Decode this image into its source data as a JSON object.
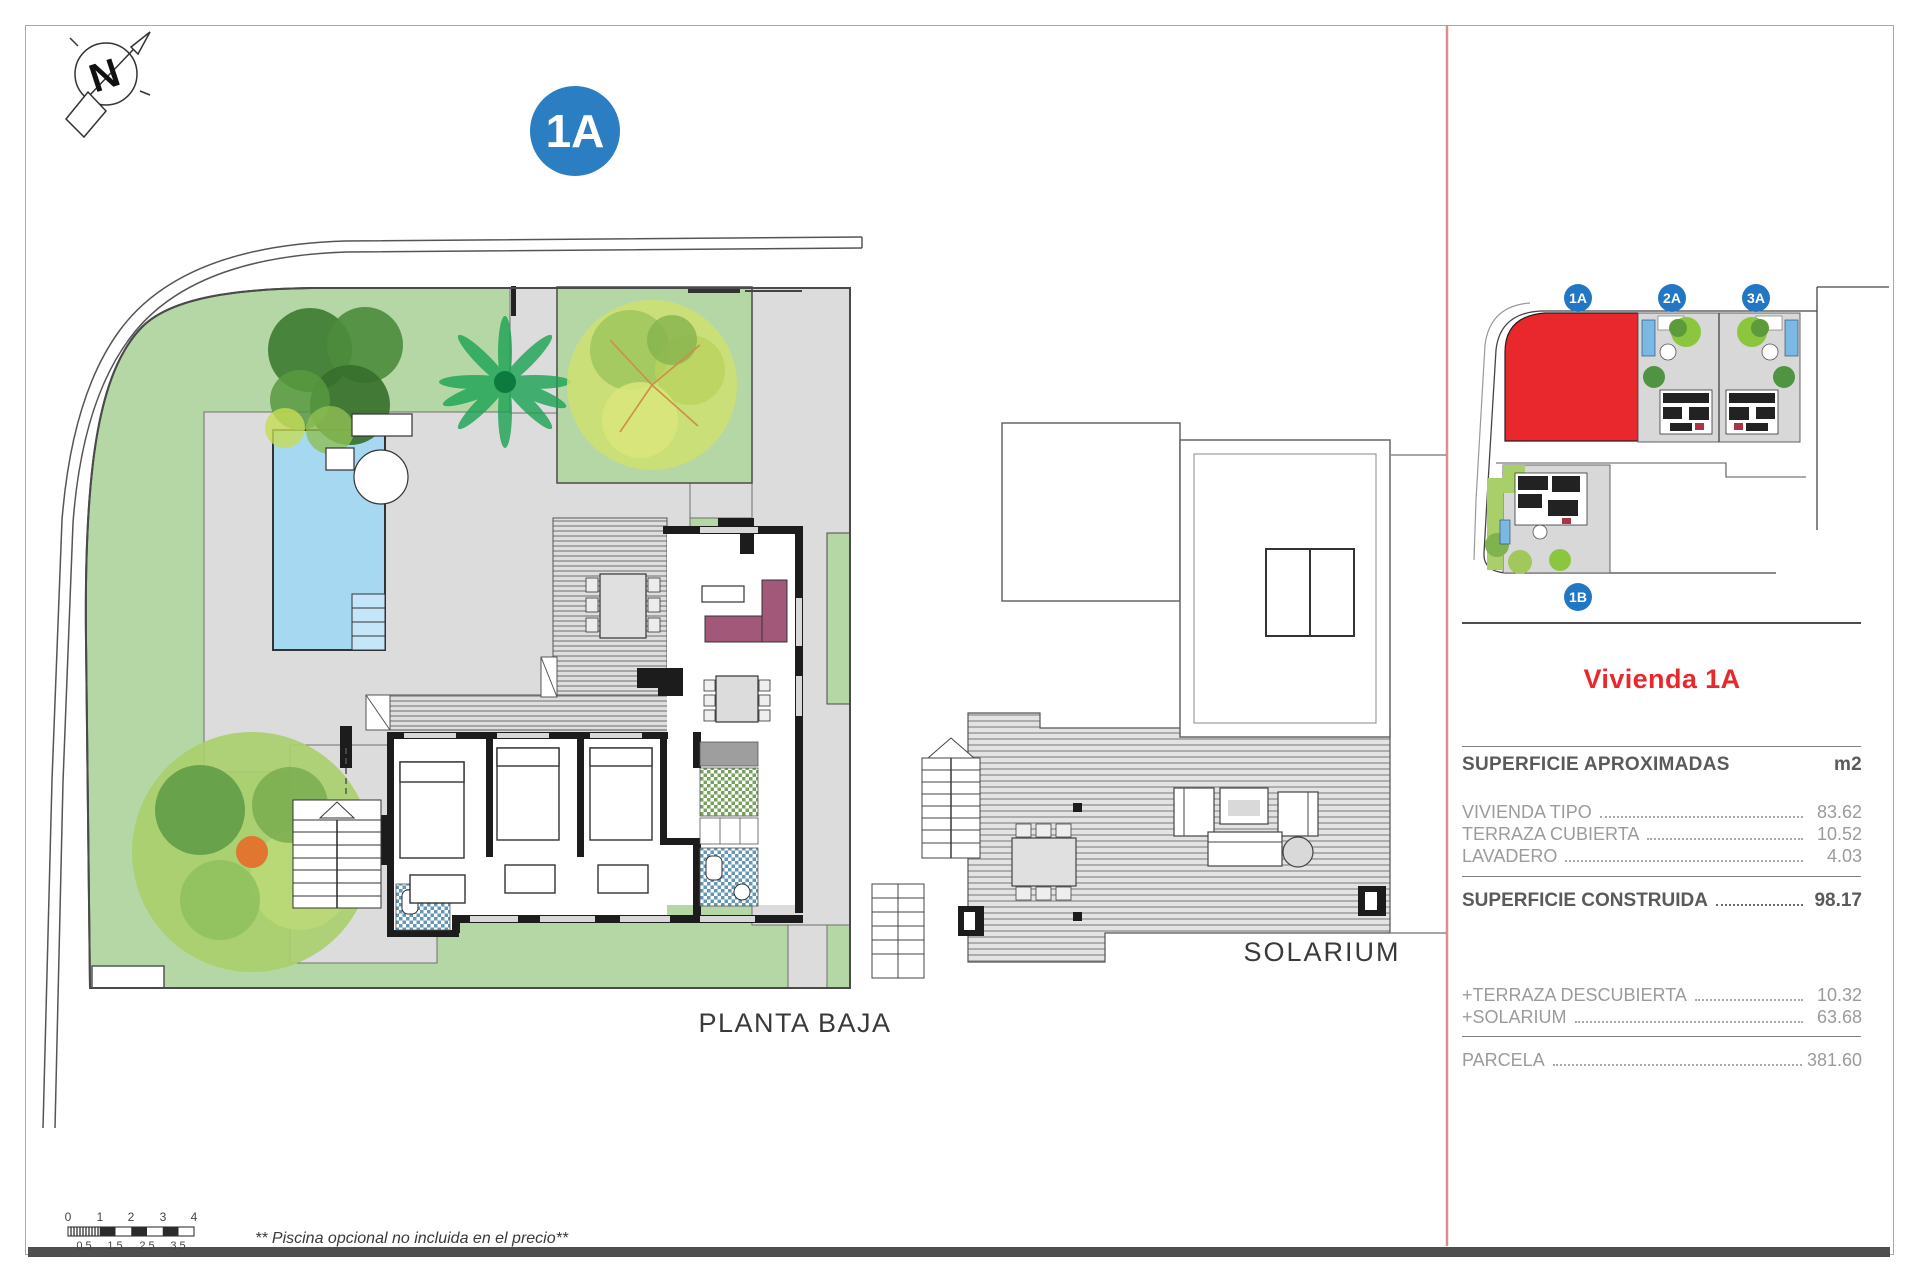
{
  "page": {
    "unit_badge": "1A",
    "compass_letter": "N",
    "plan_labels": {
      "ground": "PLANTA BAJA",
      "solarium": "SOLARIUM"
    },
    "footnote": "** Piscina opcional no incluida en el precio**"
  },
  "scale_bar": {
    "top_labels": [
      "0",
      "1",
      "2",
      "3",
      "4"
    ],
    "bottom_labels": [
      "0.5",
      "1.5",
      "2.5",
      "3.5"
    ]
  },
  "site_map": {
    "badges": [
      "1A",
      "2A",
      "3A",
      "1B"
    ],
    "highlighted_unit": "1A"
  },
  "sidebar": {
    "title": "Vivienda 1A",
    "table_header": {
      "label": "SUPERFICIE APROXIMADAS",
      "unit": "m2"
    },
    "rows": [
      {
        "label": "VIVIENDA TIPO",
        "value": "83.62"
      },
      {
        "label": "TERRAZA CUBIERTA",
        "value": "10.52"
      },
      {
        "label": "LAVADERO",
        "value": "4.03"
      }
    ],
    "total_row": {
      "label": "SUPERFICIE CONSTRUIDA",
      "value": "98.17"
    },
    "extra_rows": [
      {
        "label": "+TERRAZA DESCUBIERTA",
        "value": "10.32"
      },
      {
        "label": "+SOLARIUM",
        "value": "63.68"
      }
    ],
    "parcel_row": {
      "label": "PARCELA",
      "value": "381.60"
    }
  },
  "colors": {
    "accent_red": "#e8282d",
    "badge_blue": "#2b7ec1",
    "divider_pink": "#d98f8f",
    "garden_green": "#b5d7a5",
    "pool_blue": "#a6d8f2"
  }
}
